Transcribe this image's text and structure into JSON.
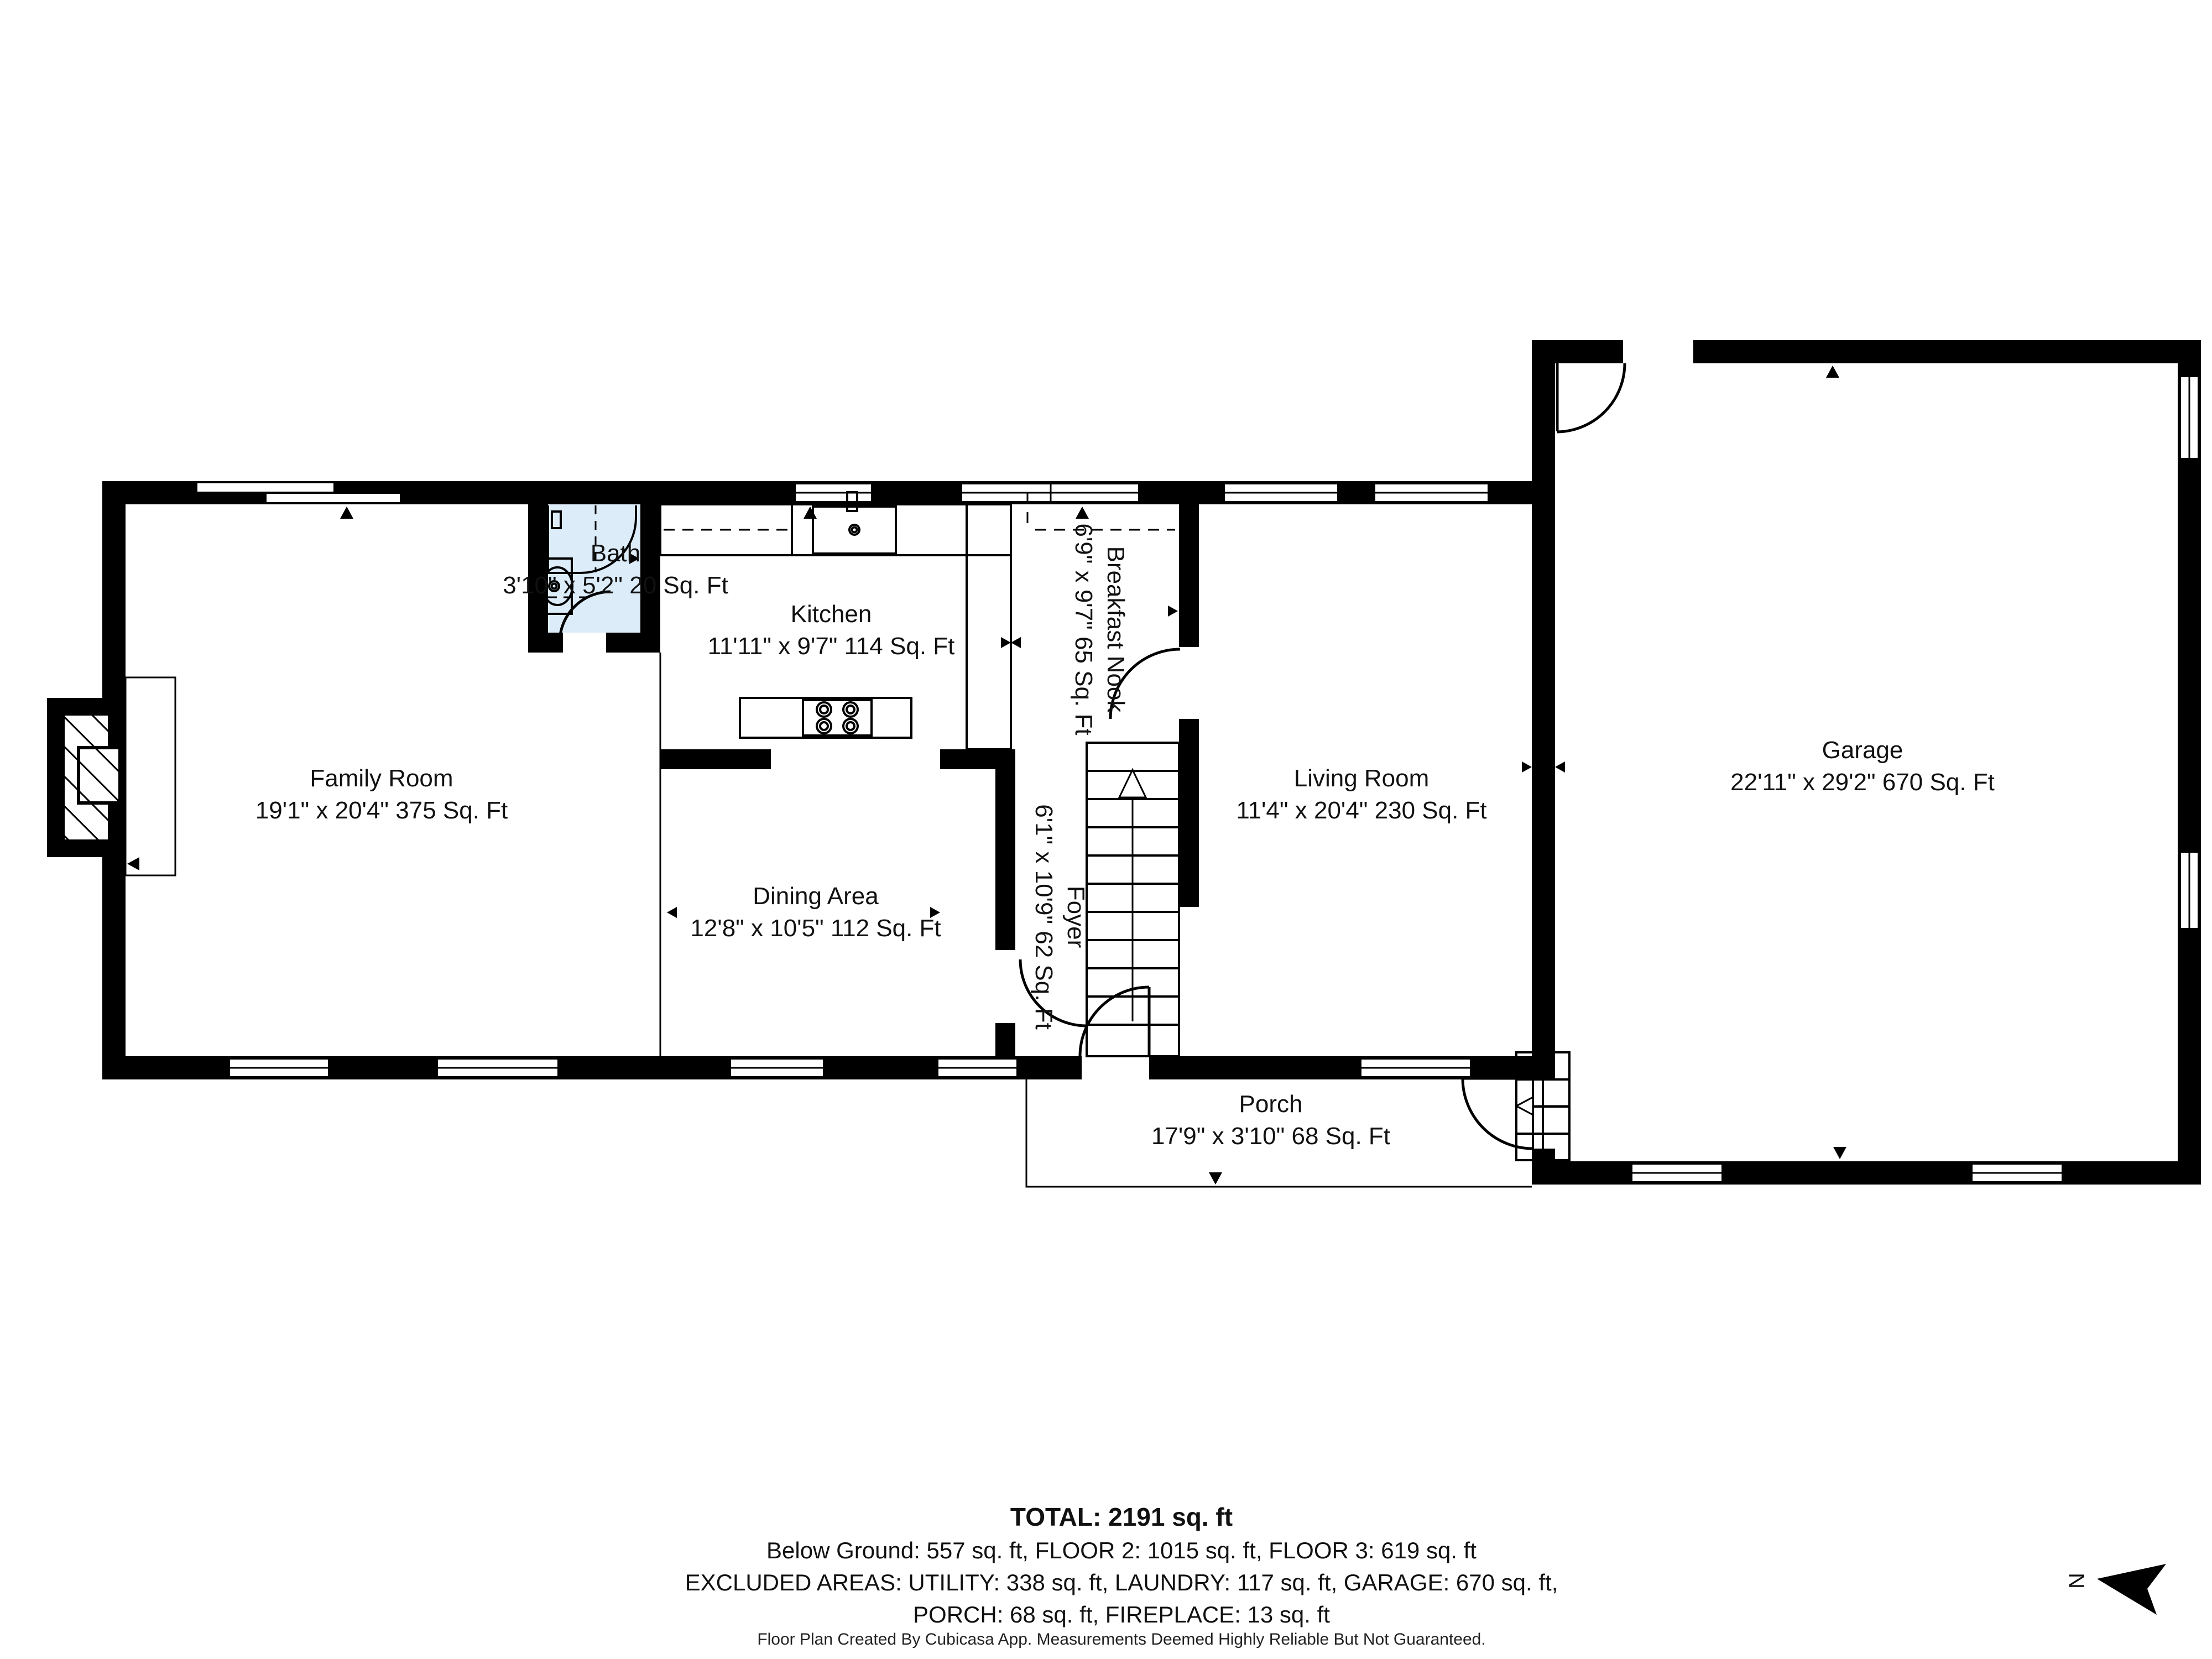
{
  "title": "Floor plan",
  "rooms": [
    {
      "id": "family_room",
      "name": "Family Room",
      "dims": "19'1\" x 20'4\" 375 Sq. Ft"
    },
    {
      "id": "bath",
      "name": "Bath",
      "dims": "3'10\" x 5'2\" 20 Sq. Ft"
    },
    {
      "id": "kitchen",
      "name": "Kitchen",
      "dims": "11'11\" x 9'7\" 114 Sq. Ft"
    },
    {
      "id": "breakfast_nook",
      "name": "Breakfast Nook",
      "dims": "6'9\" x 9'7\" 65 Sq. Ft",
      "rotated": true
    },
    {
      "id": "dining_area",
      "name": "Dining Area",
      "dims": "12'8\" x 10'5\" 112 Sq. Ft"
    },
    {
      "id": "foyer",
      "name": "Foyer",
      "dims": "6'1\" x 10'9\" 62 Sq. Ft",
      "rotated": true
    },
    {
      "id": "living_room",
      "name": "Living Room",
      "dims": "11'4\" x 20'4\" 230 Sq. Ft"
    },
    {
      "id": "garage",
      "name": "Garage",
      "dims": "22'11\" x 29'2\" 670 Sq. Ft"
    },
    {
      "id": "porch",
      "name": "Porch",
      "dims": "17'9\" x 3'10\" 68 Sq. Ft"
    }
  ],
  "summary": {
    "total": "TOTAL: 2191 sq. ft",
    "line2": "Below Ground: 557 sq. ft, FLOOR 2: 1015 sq. ft, FLOOR 3: 619 sq. ft",
    "line3": "EXCLUDED AREAS: UTILITY: 338 sq. ft, LAUNDRY: 117 sq. ft, GARAGE: 670 sq. ft,",
    "line4": "PORCH: 68 sq. ft, FIREPLACE: 13 sq. ft"
  },
  "footer": "Floor Plan Created By Cubicasa App. Measurements Deemed Highly Reliable But Not Guaranteed.",
  "compass": {
    "label": "N"
  },
  "colors": {
    "wall": "#000000",
    "bath_fill": "#dcecf9",
    "background": "#ffffff"
  }
}
